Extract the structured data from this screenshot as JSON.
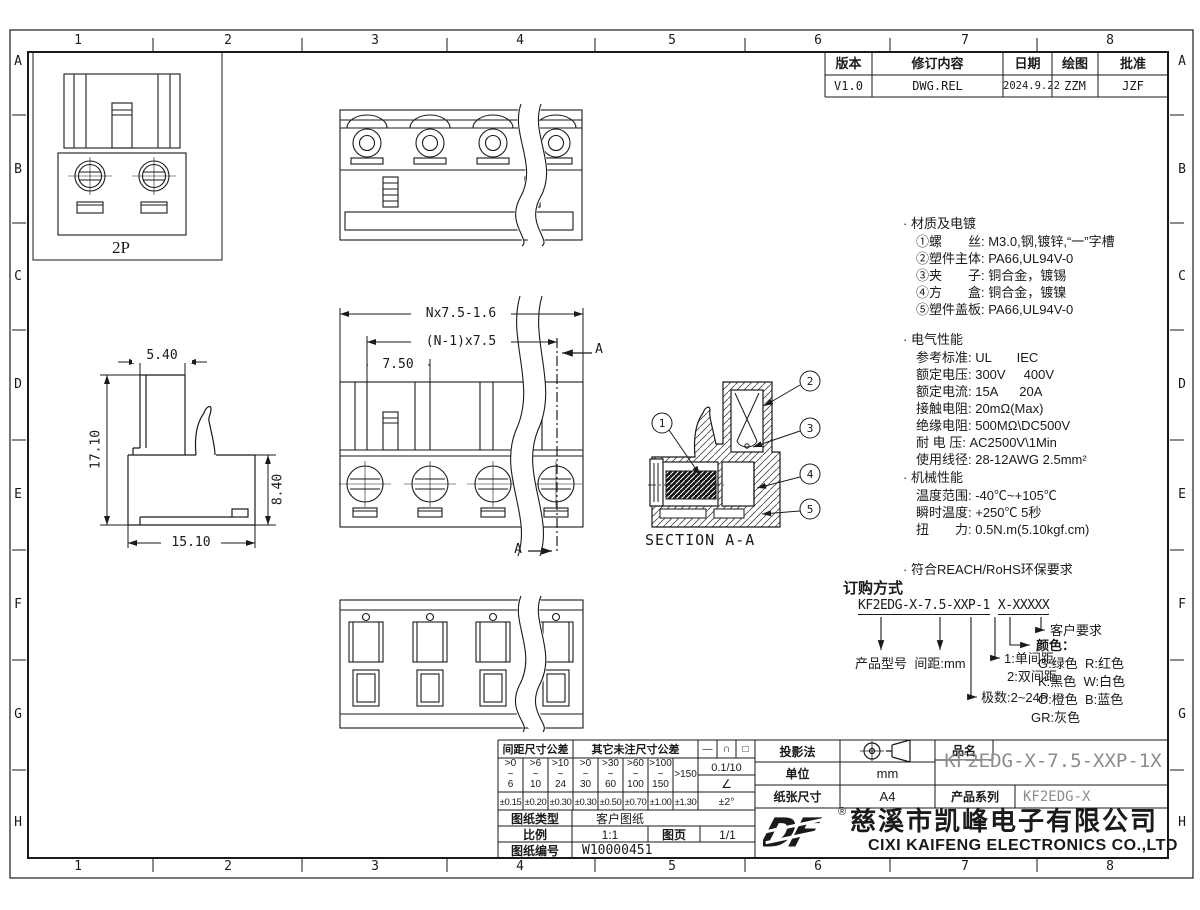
{
  "sheet": {
    "zone_numbers": [
      "1",
      "2",
      "3",
      "4",
      "5",
      "6",
      "7",
      "8"
    ],
    "zone_letters": [
      "A",
      "B",
      "C",
      "D",
      "E",
      "F",
      "G",
      "H"
    ],
    "line_color": "#1a1a1a",
    "cad_gray": "#8c8c8c"
  },
  "revision_table": {
    "col_version": "版本",
    "col_content": "修订内容",
    "col_date": "日期",
    "col_draw": "绘图",
    "col_approve": "批准",
    "row": {
      "version": "V1.0",
      "content": "DWG.REL",
      "date": "2024.9.22",
      "draw": "ZZM",
      "approve": "JZF"
    }
  },
  "views": {
    "front_2p_label": "2P",
    "section_title": "SECTION A-A",
    "section_arrow_label": "A",
    "callouts": [
      "1",
      "2",
      "3",
      "4",
      "5"
    ],
    "dims": {
      "total_width": "Nx7.5-1.6",
      "pitch_span": "(N-1)x7.5",
      "pitch": "7.50",
      "top_width": "5.40",
      "height": "17.10",
      "lower_height": "8.40",
      "bottom_width": "15.10"
    }
  },
  "specs": {
    "material_title": "· 材质及电镀",
    "material_items": [
      "①螺　　丝: M3.0,钢,镀锌,“一”字槽",
      "②塑件主体: PA66,UL94V-0",
      "③夹　　子: 铜合金，镀锡",
      "④方　　盒: 铜合金，镀镍",
      "⑤塑件盖板: PA66,UL94V-0"
    ],
    "electrical_title": "· 电气性能",
    "electrical_items": [
      "参考标准: UL       IEC",
      "额定电压: 300V     400V",
      "额定电流: 15A      20A",
      "接触电阻: 20mΩ(Max)",
      "绝缘电阻: 500MΩ\\DC500V",
      "耐 电 压: AC2500V\\1Min",
      "使用线径: 28-12AWG 2.5mm²"
    ],
    "mechanical_title": "· 机械性能",
    "mechanical_items": [
      "温度范围: -40℃~+105℃",
      "瞬时温度: +250℃ 5秒",
      "扭　　力: 0.5N.m(5.10kgf.cm)",
      "剥线长度: 7mm"
    ],
    "compliance": "· 符合REACH/RoHS环保要求"
  },
  "ordering": {
    "title": "订购方式",
    "pn_left": "KF2EDG-X-7.5-XXP-1",
    "pn_right": "X-XXXXX",
    "customer": "客户要求",
    "color_title": "颜色：",
    "colors": [
      "G:绿色  R:红色",
      "K:黑色  W:白色",
      "O:橙色  B:蓝色",
      "GR:灰色"
    ],
    "spacing1": "1:单间距",
    "spacing2": "2:双间距",
    "poles": "极数:2~24P",
    "model": "产品型号",
    "pitch": "间距:mm"
  },
  "title_block": {
    "tolerance": {
      "pitch_header": "间距尺寸公差",
      "other_header": "其它未注尺寸公差",
      "cols": [
        {
          "range": ">0\n~\n6",
          "tol": "±0.15"
        },
        {
          "range": ">6\n~\n10",
          "tol": "±0.20"
        },
        {
          "range": ">10\n~\n24",
          "tol": "±0.30"
        },
        {
          "range": ">0\n~\n30",
          "tol": "±0.30"
        },
        {
          "range": ">30\n~\n60",
          "tol": "±0.50"
        },
        {
          "range": ">60\n~\n100",
          "tol": "±0.70"
        },
        {
          "range": ">100\n~\n150",
          "tol": "±1.00"
        },
        {
          "range": ">150",
          "tol": "±1.30"
        }
      ],
      "symbols": {
        "glyph1": "—",
        "glyph2": "∩",
        "glyph3": "□",
        "flatness": "0.1/10",
        "angle": "∠",
        "angle_tol": "±2°"
      }
    },
    "fields": {
      "drawing_type_label": "图纸类型",
      "drawing_type": "客户图纸",
      "scale_label": "比例",
      "scale": "1:1",
      "sheet_label": "图页",
      "sheet": "1/1",
      "drawing_no_label": "图纸编号",
      "drawing_no": "W10000451",
      "projection_label": "投影法",
      "unit_label": "单位",
      "unit": "mm",
      "paper_label": "纸张尺寸",
      "paper": "A4",
      "part_label": "品名",
      "part_name": "KF2EDG-X-7.5-XXP-1X",
      "series_label": "产品系列",
      "series": "KF2EDG-X"
    },
    "company": {
      "logo": "DF",
      "reg": "®",
      "name_cn": "慈溪市凯峰电子有限公司",
      "name_en": "CIXI KAIFENG ELECTRONICS CO.,LTD"
    }
  }
}
